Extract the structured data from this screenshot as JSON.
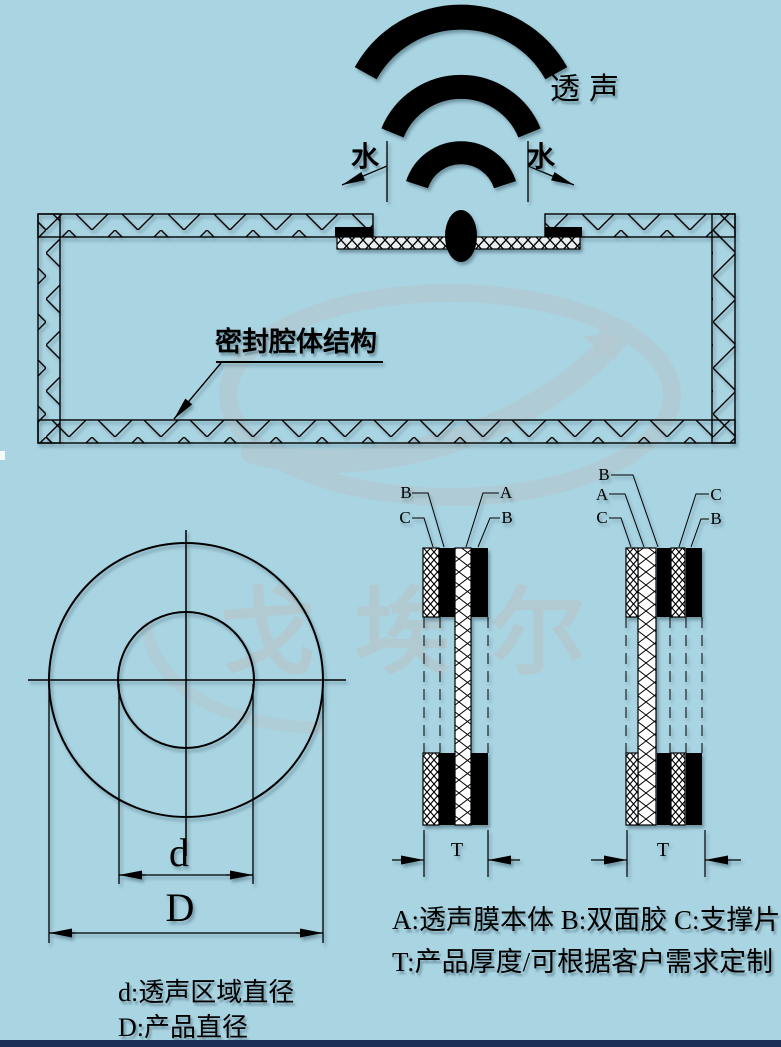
{
  "colors": {
    "background": "#a9d4e2",
    "ink": "#000000",
    "watermark": "#b4c8cf",
    "footer_bar": "#1b3054"
  },
  "top_view": {
    "sound_waves_icon": "wifi-arcs-icon",
    "sound_label": "透声",
    "water_left_label": "水",
    "water_right_label": "水",
    "cavity_label": "密封腔体结构"
  },
  "front_view": {
    "inner_dim_letter": "d",
    "outer_dim_letter": "D",
    "inner_dim_legend": "d:透声区域直径",
    "outer_dim_legend": "D:产品直径"
  },
  "stack1": {
    "label_b_left": "B",
    "label_c_left": "C",
    "label_a_right": "A",
    "label_b_right": "B",
    "thickness_letter": "T"
  },
  "stack2": {
    "label_b_left": "B",
    "label_a_left": "A",
    "label_c_left": "C",
    "label_c_right": "C",
    "label_b_right": "B",
    "thickness_letter": "T"
  },
  "legend": {
    "layers": "A:透声膜本体 B:双面胶 C:支撑片",
    "thickness": "T:产品厚度/可根据客户需求定制"
  },
  "watermark": {
    "brand_text": "戈埃尔",
    "star_icon": "star-icon",
    "swoosh_icon": "swoosh-icon"
  }
}
